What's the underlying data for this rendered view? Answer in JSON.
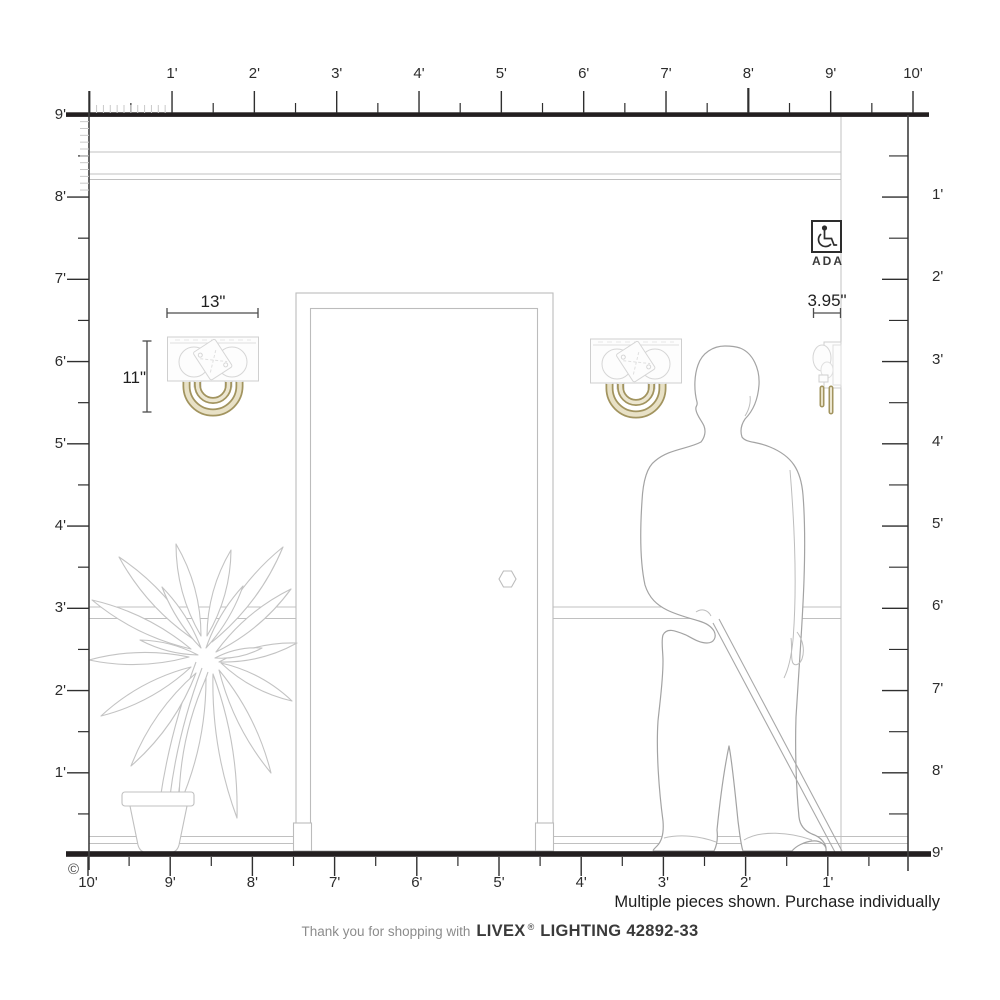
{
  "drawing": {
    "title": "wall elevation with two wall sconces, door, person with cane and potted plant",
    "accent_gold": "#a2945f",
    "line_dark": "#231f20",
    "line_light": "#c4c4c4"
  },
  "rulers": {
    "top": {
      "labels": [
        "1'",
        "2'",
        "3'",
        "4'",
        "5'",
        "6'",
        "7'",
        "8'",
        "9'",
        "10'"
      ]
    },
    "left": {
      "labels": [
        "9'",
        "8'",
        "7'",
        "6'",
        "5'",
        "4'",
        "3'",
        "2'",
        "1'"
      ]
    },
    "right": {
      "labels": [
        "1'",
        "2'",
        "3'",
        "4'",
        "5'",
        "6'",
        "7'",
        "8'",
        "9'"
      ]
    },
    "bottom": {
      "labels": [
        "10'",
        "9'",
        "8'",
        "7'",
        "6'",
        "5'",
        "4'",
        "3'",
        "2'",
        "1'"
      ]
    }
  },
  "dimensions": {
    "fixture_width": "13\"",
    "fixture_height": "11\"",
    "fixture_depth": "3.95\""
  },
  "ada": {
    "label": "ADA"
  },
  "notes": {
    "purchase_note": "Multiple pieces shown. Purchase individually"
  },
  "footer": {
    "thanks_prefix": "Thank you for shopping with",
    "brand": "LIVEX",
    "registered": "®",
    "suffix": "LIGHTING 42892-33"
  },
  "meta": {
    "copyright": "©"
  }
}
